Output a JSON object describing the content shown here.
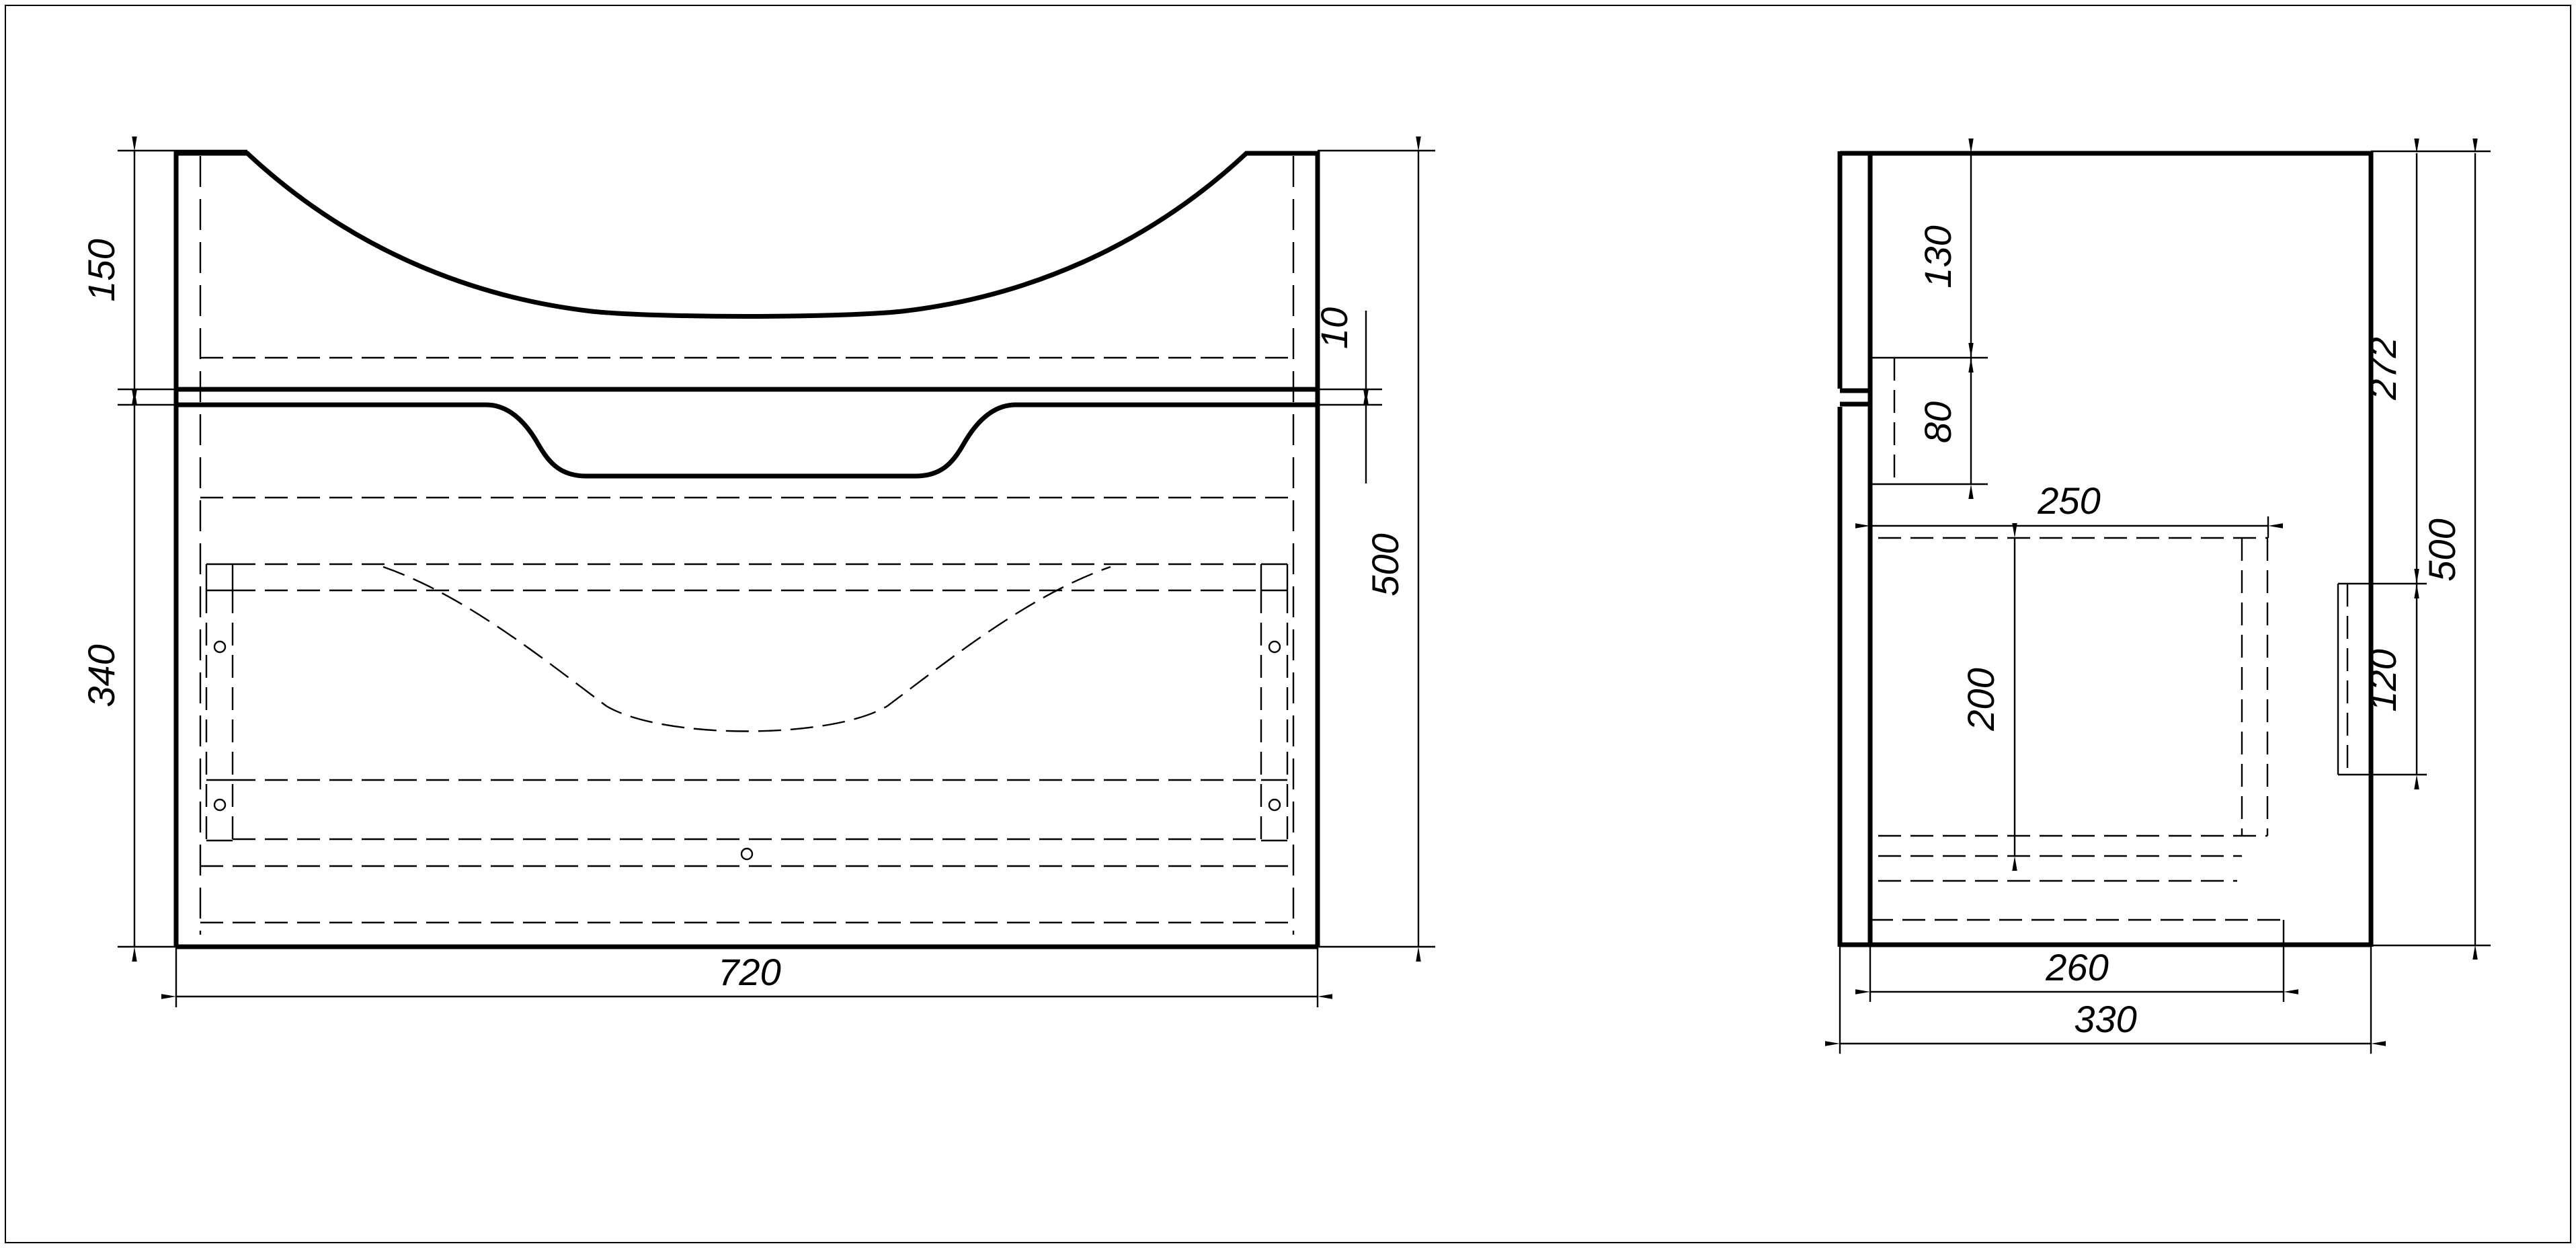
{
  "drawing": {
    "type": "technical-drawing",
    "subject": "vanity sink cabinet, two orthographic views",
    "colors": {
      "line": "#000000",
      "background": "#ffffff"
    },
    "front_view": {
      "dims": {
        "top_section_height": "150",
        "lower_section_height": "340",
        "gap": "10",
        "total_height": "500",
        "total_width": "720"
      }
    },
    "side_view": {
      "dims": {
        "front_top_offset": "130",
        "front_notch_height": "80",
        "drawer_depth": "250",
        "drawer_height": "200",
        "back_top_offset": "272",
        "bracket_height": "120",
        "total_height": "500",
        "bottom_width": "260",
        "total_depth": "330"
      }
    }
  }
}
